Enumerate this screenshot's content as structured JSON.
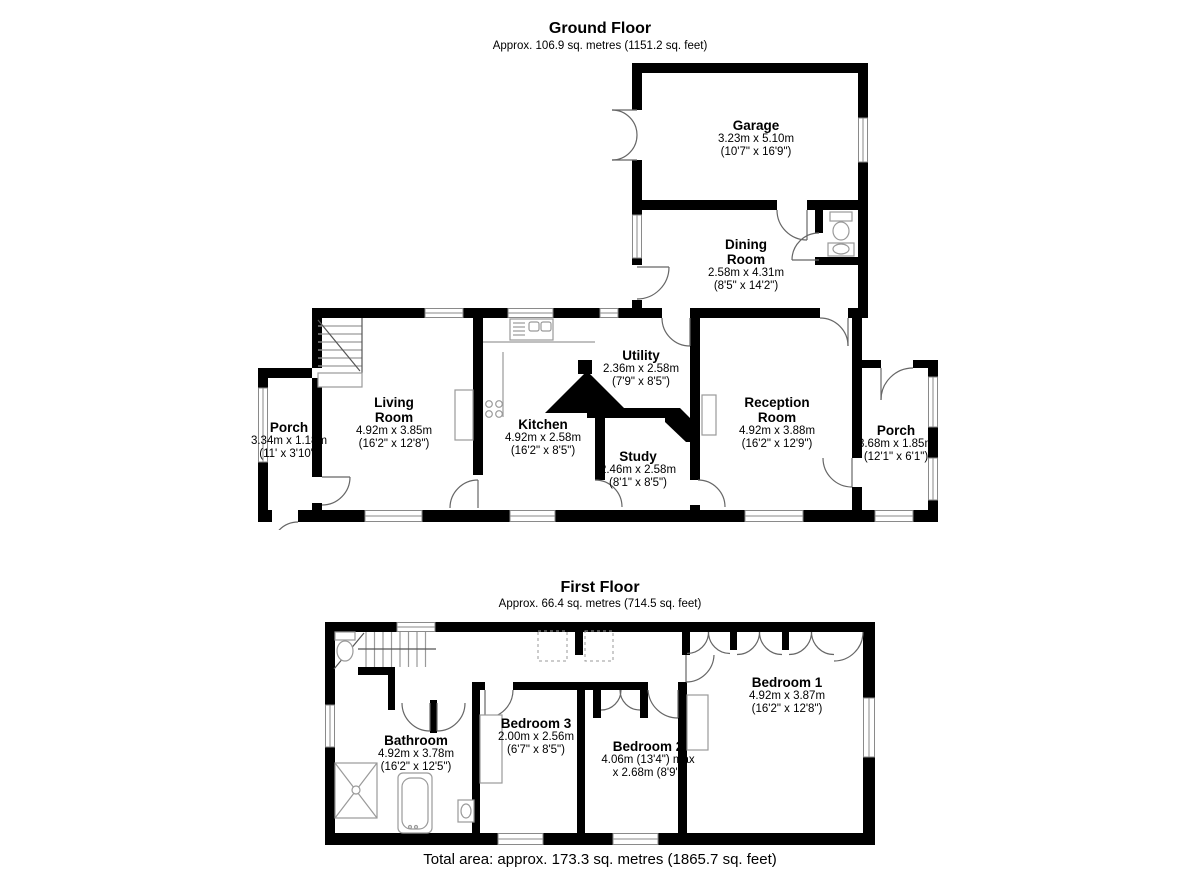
{
  "ground_floor": {
    "title": "Ground Floor",
    "subtitle": "Approx. 106.9 sq. metres (1151.2 sq. feet)",
    "rooms": {
      "garage": {
        "name": "Garage",
        "metric": "3.23m x 5.10m",
        "imperial": "(10'7\" x 16'9\")"
      },
      "dining": {
        "name": "Dining Room",
        "metric": "2.58m x 4.31m",
        "imperial": "(8'5\" x 14'2\")"
      },
      "living": {
        "name": "Living Room",
        "metric": "4.92m x 3.85m",
        "imperial": "(16'2\" x 12'8\")"
      },
      "kitchen": {
        "name": "Kitchen",
        "metric": "4.92m x 2.58m",
        "imperial": "(16'2\" x 8'5\")"
      },
      "utility": {
        "name": "Utility",
        "metric": "2.36m x 2.58m",
        "imperial": "(7'9\" x 8'5\")"
      },
      "study": {
        "name": "Study",
        "metric": "2.46m x 2.58m",
        "imperial": "(8'1\" x 8'5\")"
      },
      "reception": {
        "name": "Reception Room",
        "metric": "4.92m x 3.88m",
        "imperial": "(16'2\" x 12'9\")"
      },
      "porch_left": {
        "name": "Porch",
        "metric": "3.34m x 1.18m",
        "imperial": "(11' x 3'10\")"
      },
      "porch_right": {
        "name": "Porch",
        "metric": "3.68m x 1.85m",
        "imperial": "(12'1\" x 6'1\")"
      }
    }
  },
  "first_floor": {
    "title": "First Floor",
    "subtitle": "Approx. 66.4 sq. metres (714.5 sq. feet)",
    "rooms": {
      "bathroom": {
        "name": "Bathroom",
        "metric": "4.92m x 3.78m",
        "imperial": "(16'2\" x 12'5\")"
      },
      "bedroom3": {
        "name": "Bedroom 3",
        "metric": "2.00m x 2.56m",
        "imperial": "(6'7\" x 8'5\")"
      },
      "bedroom2": {
        "name": "Bedroom 2",
        "metric": "4.06m (13'4\") max",
        "imperial": "x 2.68m (8'9\")"
      },
      "bedroom1": {
        "name": "Bedroom 1",
        "metric": "4.92m x 3.87m",
        "imperial": "(16'2\" x 12'8\")"
      }
    }
  },
  "footer": {
    "total": "Total area: approx. 173.3 sq. metres (1865.7 sq. feet)"
  },
  "colors": {
    "wall": "#000000",
    "fixture": "#9a9a9a",
    "background": "#ffffff"
  }
}
